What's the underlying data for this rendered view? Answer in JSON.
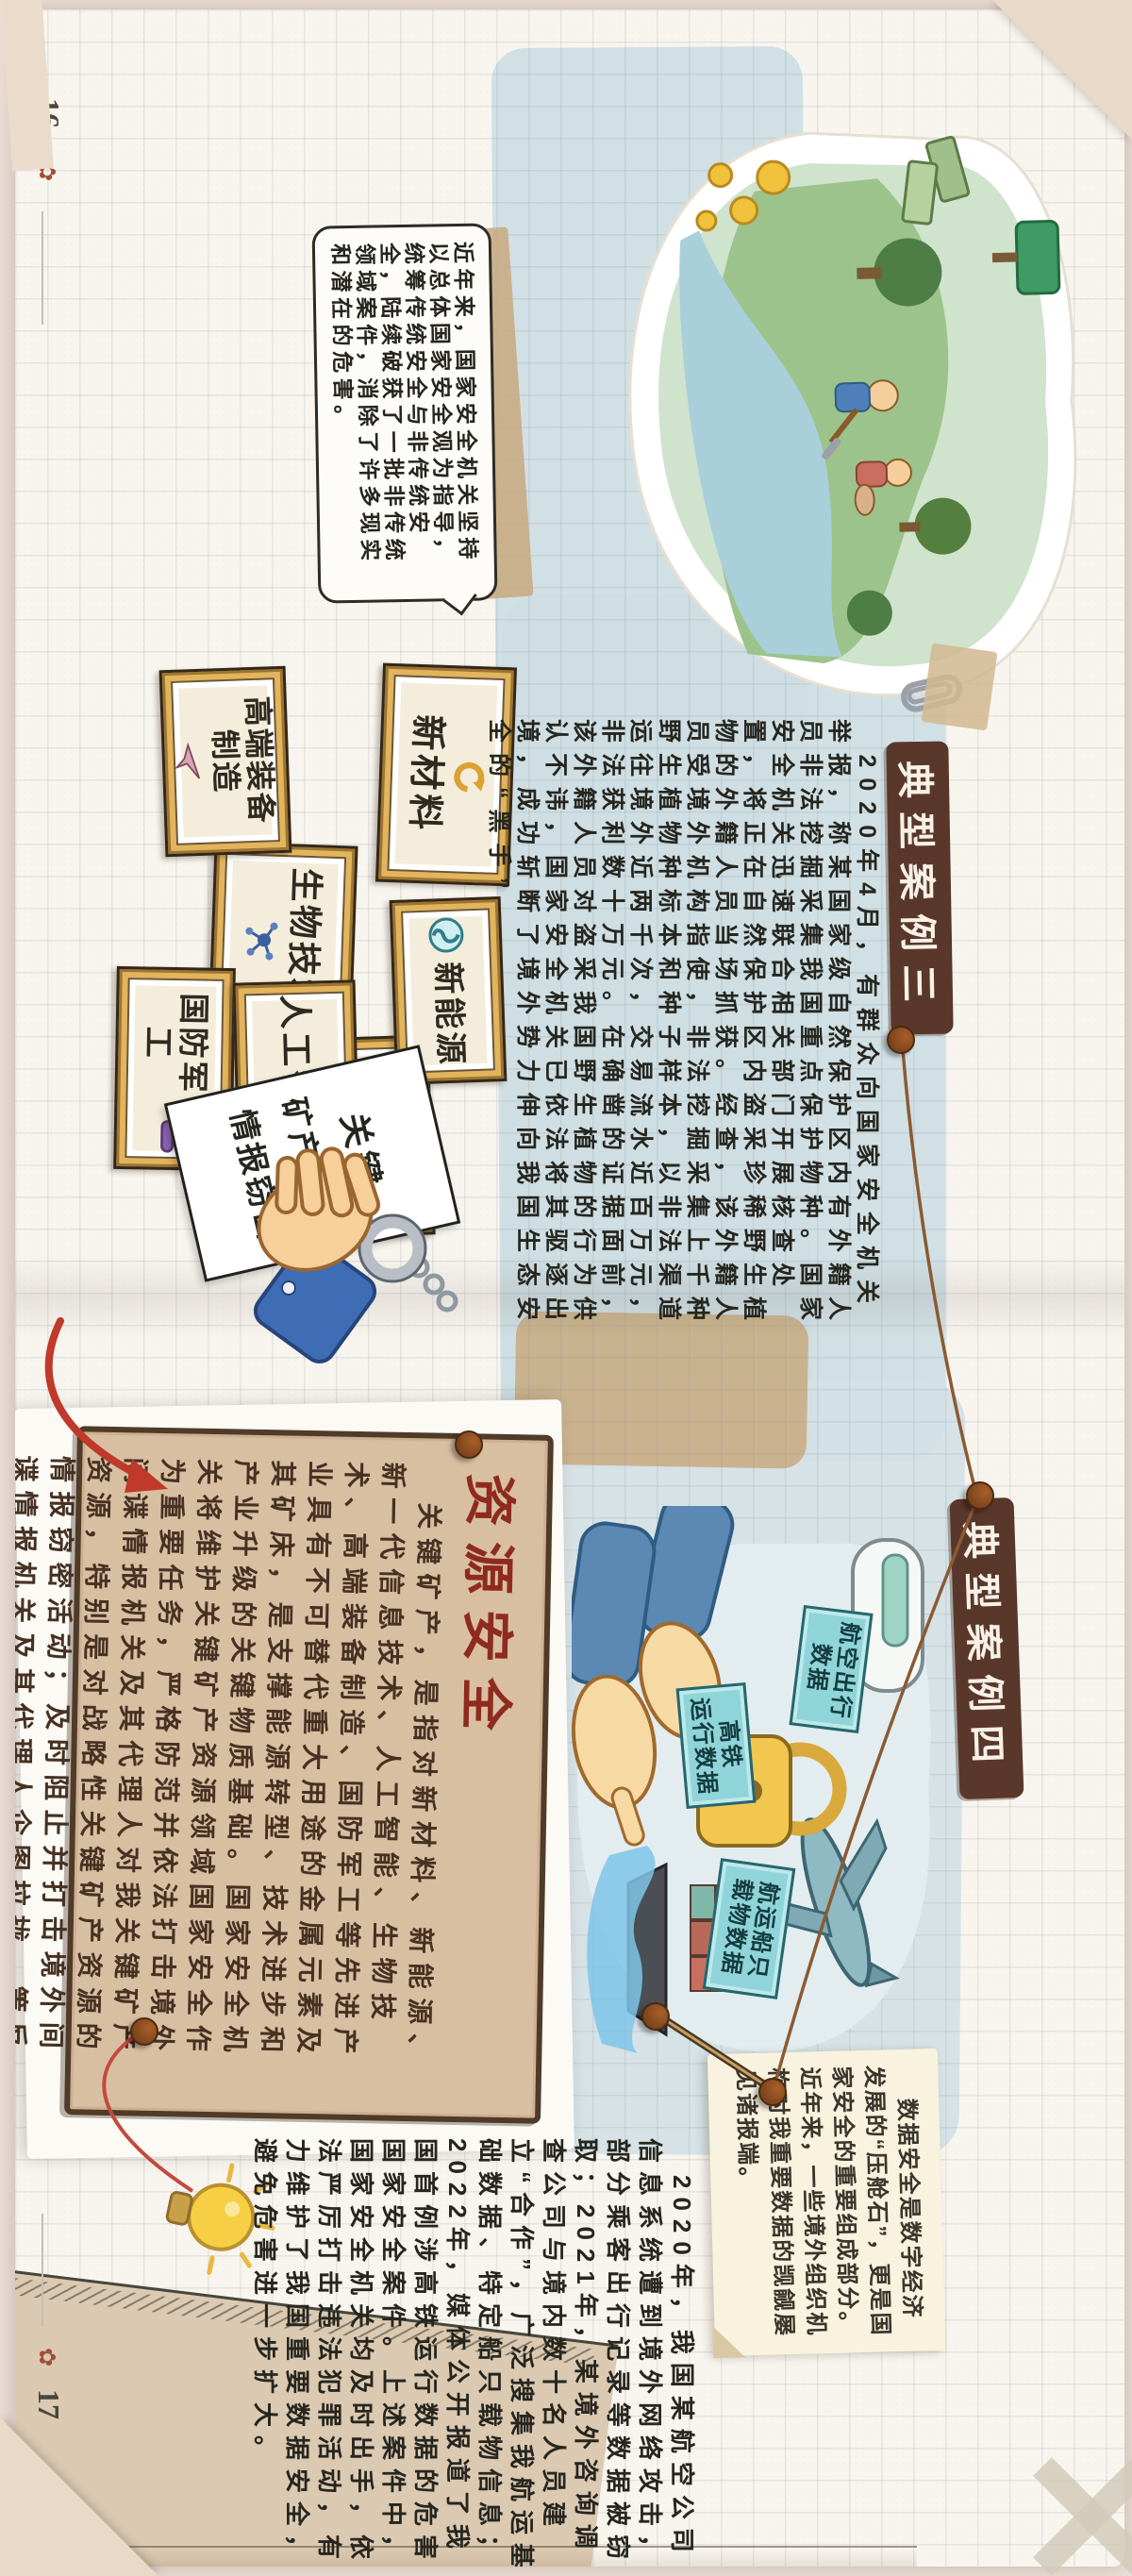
{
  "page": {
    "left_number": "16",
    "right_number": "17"
  },
  "colors": {
    "backdrop": "#efe1d9",
    "paper": "#f8f5ef",
    "blue_wash": "#cddde3",
    "ribbon_brown": "#5a372b",
    "resource_paper_tan": "#d9bfa2",
    "resource_title_red": "#8e2b1e",
    "tag_teal": "#8fd4d8",
    "frame_gold": "#e2b45c",
    "accent_red": "#c0392b"
  },
  "intro": {
    "text": "近年来，国家安全机关坚持以总体国家安全观为指导，统筹传统安全与非传统安全，陆续破获了一批非传统领域案件，消除了许多现实和潜在的危害。"
  },
  "case3": {
    "title": "典型案例三",
    "body": "2020年4月，有群众向国家安全机关举报，称某国家级自然保护区内有外籍人员非法挖掘采集我国重点保护物种。国家安全机关迅速联合相关部门开展核查处置，将正在自然保护区内盗采珍稀野生植物的外籍人员当场抓获。经查，该外籍人员受境外机构指使，非法挖掘采集上千种野生植物种标本和种子样本，以非法渠道运往境外近两千次，交易流水近百万元，非法获利数十万元。在确凿的证据面前，该外籍人员对盗采我国野生植物的行为供认不讳，国家安全机关已依法将其驱逐出境，成功斩断了境外势力伸向我国生态安全的“黑手”。"
  },
  "industries": {
    "items": [
      {
        "label": "新材料",
        "icon": "recycle-icon"
      },
      {
        "label": "高端装备\n制造",
        "icon": "airplane-icon"
      },
      {
        "label": "生物技术",
        "icon": "molecule-icon"
      },
      {
        "label": "新能源",
        "icon": "energy-icon"
      },
      {
        "label": "国防军工",
        "icon": "tank-icon"
      },
      {
        "label": "人工智能",
        "icon": "ai-chip-icon",
        "badge": "Ai"
      },
      {
        "label": "新一代\n信息技术",
        "icon": "envelope-icon"
      }
    ]
  },
  "evidence": {
    "line1": "关键",
    "line2": "矿产资源",
    "line3": "情报窃密"
  },
  "resource": {
    "title": "资源安全",
    "body": "关键矿产，是指对新材料、新能源、新一代信息技术、人工智能、生物技术、高端装备制造、国防军工等先进产业具有不可替代重大用途的金属元素及其矿床，是支撑能源转型、技术进步和产业升级的关键物质基础。国家安全机关将维护关键矿产资源领域国家安全作为重要任务，严格防范并依法打击境外间谍情报机关及其代理人对我关键矿产资源，特别是对战略性关键矿产资源的情报窃密活动；及时阻止并打击境外间谍情报机关及其代理人企图拉拢、策反我相关领域人员的卑劣图谋；维护我国海外矿产合作项目安全，保障我国关键矿产资源供应链安全。"
  },
  "case4": {
    "title": "典型案例四",
    "note": "数据安全是数字经济发展的“压舱石”，更是国家安全的重要组成部分。近年来，一些境外组织机构对我重要数据的觊觎屡见诸报端。",
    "body": "2020年，我国某航空公司信息系统遭到境外网络攻击，部分乘客出行记录等数据被窃取；2021年，某境外咨询调查公司与境内数十名人员建立“合作”，广泛搜集我航运基础数据、特定船只载物信息；2022年，媒体公开报道了我国首例涉高铁运行数据的危害国家安全案件。上述案件中，国家安全机关均及时出手，依法严厉打击违法犯罪活动，有力维护了我国重要数据安全，避免危害进一步扩大。",
    "tags": [
      "航空出行\n数据",
      "高铁\n运行数据",
      "航运船只\n载物数据"
    ]
  }
}
